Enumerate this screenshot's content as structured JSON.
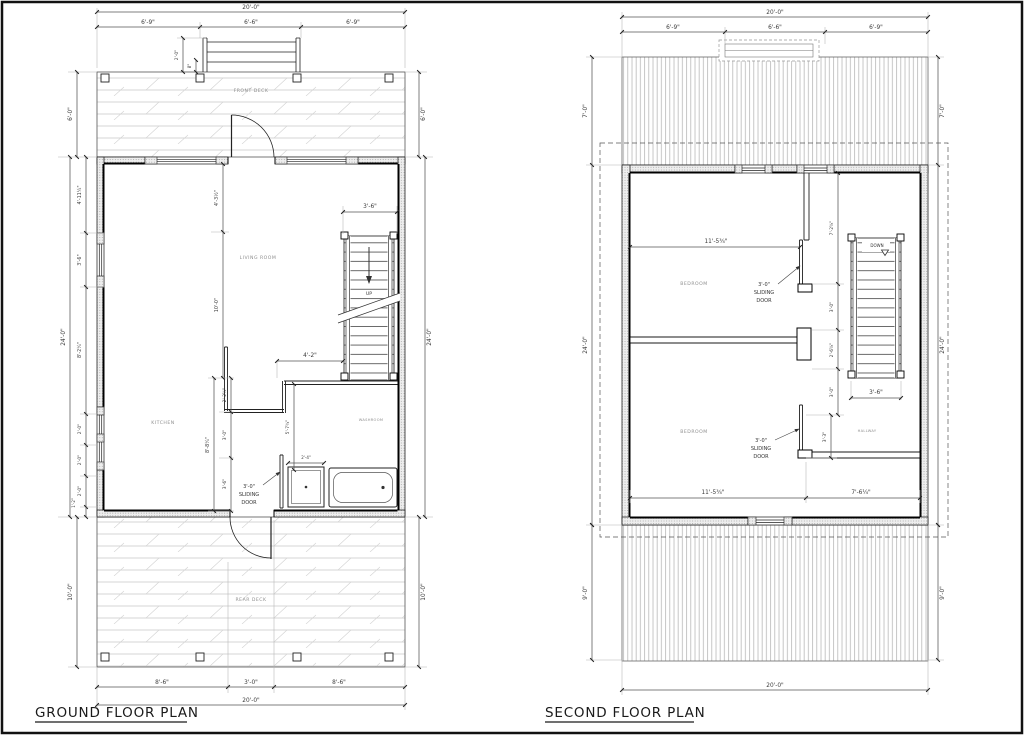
{
  "drawing": {
    "gf": {
      "title": "GROUND FLOOR PLAN",
      "labels": {
        "front_deck": "FRONT DECK",
        "rear_deck": "REAR DECK",
        "living_room": "LIVING ROOM",
        "kitchen": "KITCHEN",
        "washroom": "WASHROOM",
        "up": "UP",
        "sd_size": "3'-0\"",
        "sd_line1": "SLIDING",
        "sd_line2": "DOOR"
      },
      "dims": {
        "width_total": "20'-0\"",
        "top_left": "6'-9\"",
        "top_mid": "6'-6\"",
        "top_right": "6'-9\"",
        "steps_depth": "2'-0\"",
        "steps_offset": "8\"",
        "front_deck_depth": "6'-0\"",
        "height_total": "24'-0\"",
        "left_chain_1": "4'-11¼\"",
        "left_chain_2": "3'-6\"",
        "left_chain_3": "8'-2¼\"",
        "left_chain_4": "2'-0\"",
        "left_chain_5": "2'-0\"",
        "left_chain_6": "2'-0\"",
        "left_chain_7": "1'-2\"",
        "rear_deck_depth": "10'-0\"",
        "bottom_left": "8'-6\"",
        "bottom_mid": "3'-0\"",
        "bottom_right": "8'-6\"",
        "living_top": "4'-3½\"",
        "living_height": "10'-0\"",
        "stair_width": "3'-6\"",
        "hall_width": "4'-2\"",
        "kitchen_chain_total": "8'-8¼\"",
        "kitchen_chain_1": "2'-2¼\"",
        "kitchen_chain_2": "3'-0\"",
        "kitchen_chain_3": "3'-6\"",
        "washroom_depth": "5'-7¾\"",
        "shower_width": "2'-4\""
      }
    },
    "sf": {
      "title": "SECOND FLOOR PLAN",
      "labels": {
        "bedroom": "BEDROOM",
        "hallway": "HALLWAY",
        "down": "DOWN",
        "sd_size": "3'-0\"",
        "sd_line1": "SLIDING",
        "sd_line2": "DOOR"
      },
      "dims": {
        "width_total": "20'-0\"",
        "top_left": "6'-9\"",
        "top_mid": "6'-6\"",
        "top_right": "6'-9\"",
        "roof_top": "7'-0\"",
        "height_total": "24'-0\"",
        "roof_bottom": "9'-0\"",
        "bedroom_width": "11'-5¾\"",
        "right_chain_1": "7'-2⅝\"",
        "right_chain_2": "3'-0\"",
        "right_chain_3": "2'-6⅝\"",
        "right_chain_4": "3'-0\"",
        "hall_door": "3'-3\"",
        "stair_width": "3'-6\"",
        "bottom_right": "7'-6¼\""
      }
    }
  }
}
